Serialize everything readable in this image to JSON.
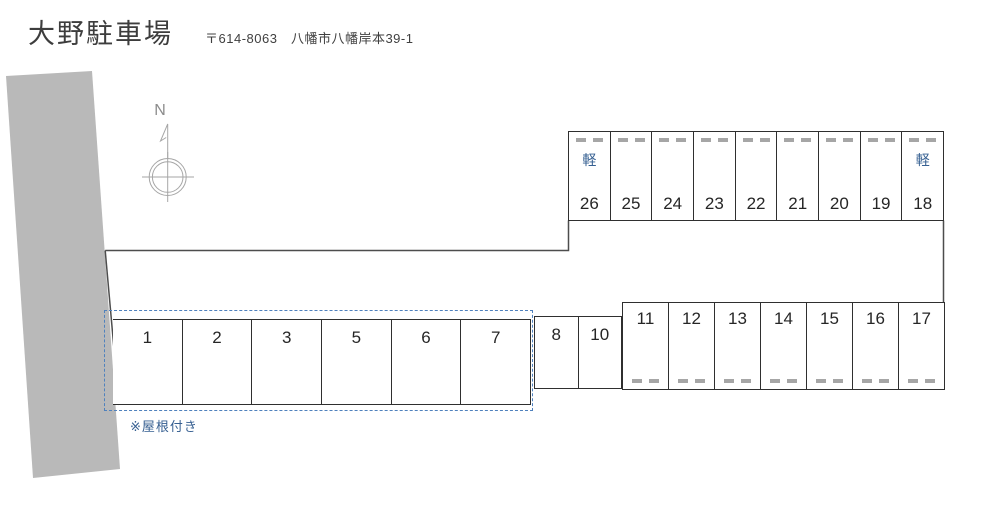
{
  "header": {
    "title": "大野駐車場",
    "postal_address": "〒614-8063　八幡市八幡岸本39-1"
  },
  "compass": {
    "north_label": "N"
  },
  "lot": {
    "kei_label": "軽",
    "covered_note": "※屋根付き",
    "rows": {
      "top": [
        "26",
        "25",
        "24",
        "23",
        "22",
        "21",
        "20",
        "19",
        "18"
      ],
      "right": [
        "11",
        "12",
        "13",
        "14",
        "15",
        "16",
        "17"
      ],
      "middle": [
        "8",
        "10"
      ],
      "covered": [
        "1",
        "2",
        "3",
        "5",
        "6",
        "7"
      ]
    },
    "kei_spaces": [
      "26",
      "18"
    ]
  },
  "colors": {
    "road_fill": "#b9b9b9",
    "cell_border": "#2f2f2f",
    "boundary_line": "#4d4d4d",
    "wheel_stop": "#a6a6a6",
    "compass": "#a6a6a6",
    "kei_blue": "#366092",
    "covered_dash_blue": "#4f81bd",
    "note_blue": "#365f91",
    "number_text": "#262626",
    "title_text": "#3d3d3d"
  }
}
